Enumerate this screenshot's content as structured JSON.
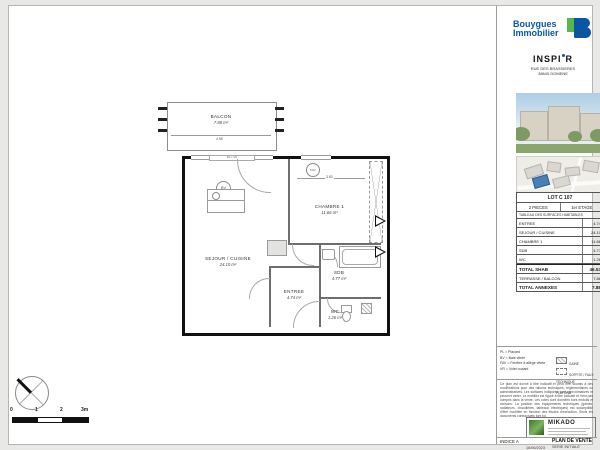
{
  "header": {
    "brand_line1": "Bouygues",
    "brand_line2": "Immobilier",
    "project_left": "INSPI",
    "project_right": "R",
    "address_line1": "RUE DES BRASSIERES",
    "address_line2": "38640 DOMENE"
  },
  "lot": {
    "title": "LOT C 107",
    "rooms": "2 PIECES",
    "floor": "1er ETAGE",
    "table_title": "TABLEAU DES SURFACES HABITABLES",
    "rows": [
      {
        "label": "ENTREE",
        "value": "4.74"
      },
      {
        "label": "SEJOUR / CUISINE",
        "value": "24.10"
      },
      {
        "label": "CHAMBRE 1",
        "value": "11.66"
      },
      {
        "label": "SDB",
        "value": "4.77"
      },
      {
        "label": "WC",
        "value": "1.26"
      }
    ],
    "total_shab_label": "TOTAL SHAB",
    "total_shab_value": "46.53",
    "annex_label": "TERRASSE / BALCON",
    "annex_value": "7.88",
    "total_annexes_label": "TOTAL ANNEXES",
    "total_annexes_value": "7.88"
  },
  "plan": {
    "balcon_name": "BALCON",
    "balcon_area": "7.88 m²",
    "balcon_dim": "4.98",
    "chambre_name": "CHAMBRE 1",
    "chambre_area": "11.66 m²",
    "chambre_dim": "3.83",
    "sejour_name": "SEJOUR / CUISINE",
    "sejour_area": "24.10 m²",
    "entree_name": "ENTREE",
    "entree_area": "4.74 m²",
    "sdb_name": "SDB",
    "sdb_area": "4.77 m²",
    "wc_name": "WC",
    "wc_area": "1.26 m²",
    "bv_label": "BV",
    "fav_label": "FAV",
    "window_label": "BV + VR"
  },
  "scale": {
    "t0": "0",
    "t1": "1",
    "t2": "2",
    "t3": "3m"
  },
  "legend": {
    "items": [
      "PL = Placard",
      "BV = Baie vitrée",
      "FAV = Fenêtre à allège vitrée",
      "VR = Volet roulant"
    ],
    "symbol1": "GAINE TECHNIQUE",
    "symbol2": "SOFFITE / FAUX PLAFOND"
  },
  "notes": "Ce plan est donné à titre indicatif et peut être soumis à des modifications pour des raisons techniques, réglementaires ou administratives. Les surfaces indiquées sont approximatives et peuvent varier. Le mobilier est figuré à titre indicatif et n'est pas compris dans la vente. Les cotes sont données hors enduits et cloisons. La position des équipements techniques (gaines, radiateurs, chaudières, tableaux électriques) est susceptible d'être modifiée en fonction des études d'exécution. Seuls les documents contractuels font foi.",
  "stamp": {
    "name": "MIKADO"
  },
  "titleblock": {
    "indice": "INDICE  A",
    "date": "16/06/2023",
    "title": "PLAN DE VENTE",
    "subtitle": "SERIE INITIALE"
  }
}
